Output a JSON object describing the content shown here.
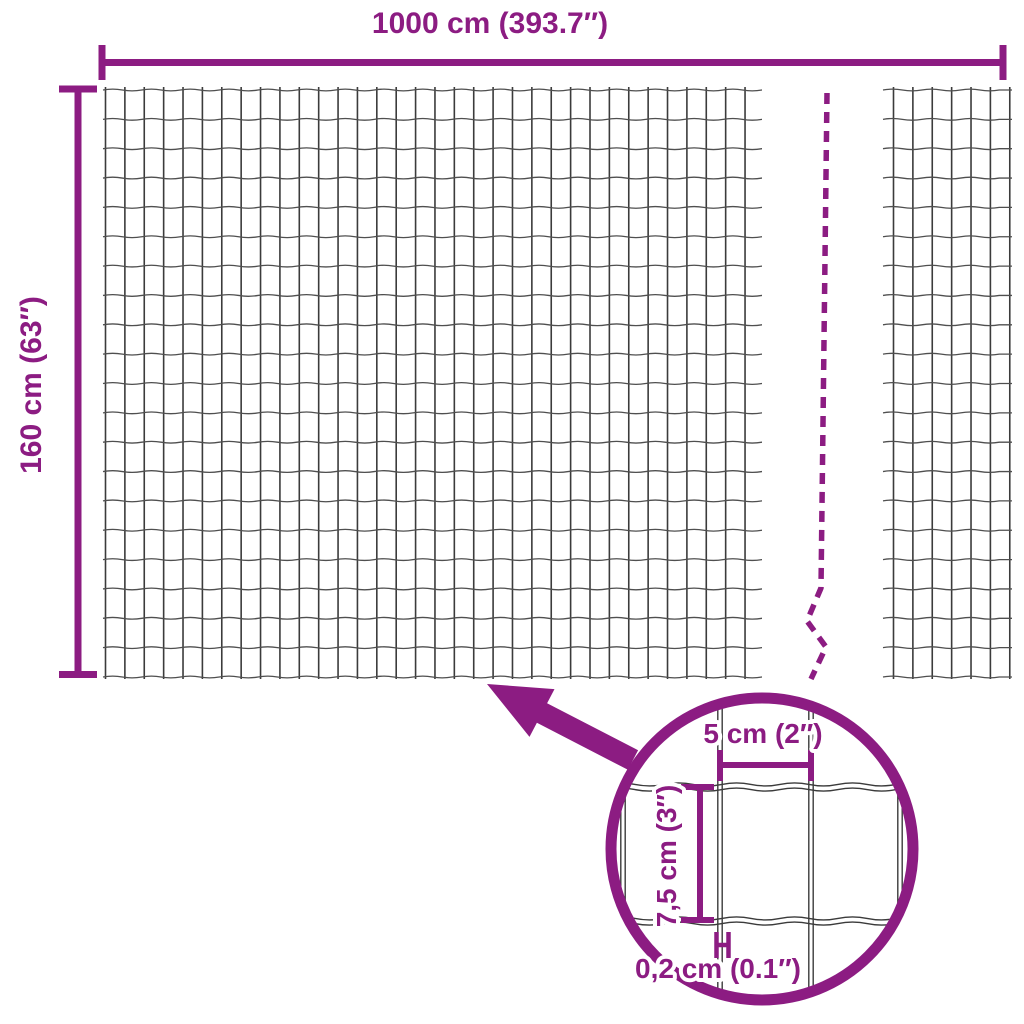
{
  "colors": {
    "accent": "#8C1C82",
    "wire_dark": "#3b3b3b",
    "wire_light": "#4f4f4f",
    "background": "#ffffff"
  },
  "main_dimensions": {
    "width_label": "1000 cm (393.7″)",
    "height_label": "160 cm (63″)"
  },
  "detail_callout": {
    "cell_width_label": "5 cm (2″)",
    "cell_height_label": "7,5 cm (3″)",
    "wire_thickness_label": "0,2 cm (0.1″)"
  }
}
